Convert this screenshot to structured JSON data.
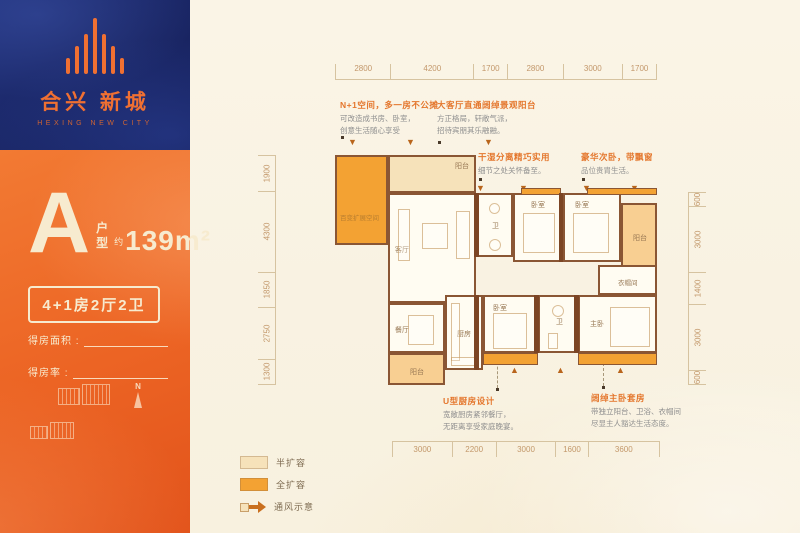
{
  "brand": {
    "logo_icon": "building-bars-icon",
    "name_cn": "合兴 新城",
    "name_en": "HEXING NEW CITY"
  },
  "unit": {
    "letter": "A",
    "type_label": "户型",
    "approx_label": "约",
    "area": "139m²",
    "spec": "4+1房2厅2卫",
    "fields": [
      {
        "label": "得房面积 :"
      },
      {
        "label": "得房率 :"
      }
    ],
    "compass_label": "N"
  },
  "callouts": {
    "top": [
      {
        "title": "N+1空间，多一房不公摊",
        "body": "可改造成书房、卧室，\n创意生活随心享受"
      },
      {
        "title": "大客厅直通阔绰景观阳台",
        "body": "方正格局，轩敞气派，\n招待宾朋其乐融融。"
      }
    ],
    "mid": [
      {
        "title": "干湿分离精巧实用",
        "body": "细节之处关怀备至。"
      },
      {
        "title": "豪华次卧，带飘窗",
        "body": "品位贵胄生活。"
      }
    ],
    "bottom": [
      {
        "title": "U型厨房设计",
        "body": "宽敞厨房紧邻餐厅，\n无距离享受家庭晚宴。"
      },
      {
        "title": "阔绰主卧套房",
        "body": "带独立阳台、卫浴、衣帽间\n尽显主人豁达生活态度。"
      }
    ]
  },
  "dimensions": {
    "top": [
      "2800",
      "4200",
      "1700",
      "2800",
      "3000",
      "1700"
    ],
    "left": [
      "1900",
      "4300",
      "1850",
      "2750",
      "1300"
    ],
    "right": [
      "600",
      "3000",
      "1400",
      "3000",
      "600"
    ],
    "bottom": [
      "3000",
      "2200",
      "3000",
      "1600",
      "3600"
    ]
  },
  "rooms": {
    "expand_space": "百变扩展空间",
    "balcony_top": "阳台",
    "living": "客厅",
    "bath_1": "卫",
    "bedroom_1": "卧室",
    "bedroom_2": "卧室",
    "balcony_right": "阳台",
    "cloakroom": "衣帽间",
    "master": "主卧",
    "bath_2": "卫",
    "bedroom_3": "卧室",
    "kitchen": "厨房",
    "dining": "餐厅",
    "balcony_bottom": "阳台"
  },
  "legend": [
    {
      "type": "half",
      "label": "半扩容"
    },
    {
      "type": "full",
      "label": "全扩容"
    },
    {
      "type": "arrow",
      "label": "通风示意"
    }
  ],
  "colors": {
    "brand_blue": "#1a2665",
    "brand_orange": "#f07032",
    "panel_orange": "#ec6424",
    "full_expand": "#f3a233",
    "half_expand": "#f6e2ba",
    "balcony": "#f8cf92",
    "wall": "#8a5634",
    "callout_title": "#e4762c",
    "dim_text": "#c3986b"
  }
}
